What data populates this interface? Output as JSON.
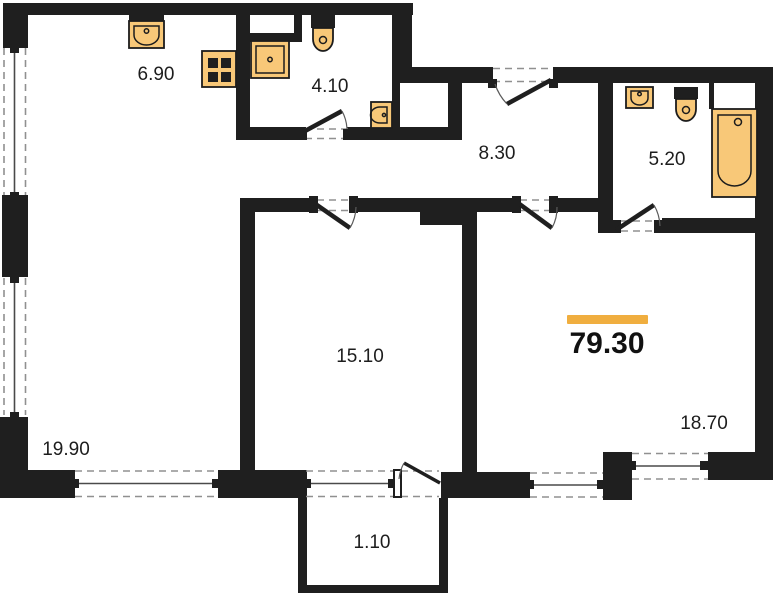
{
  "floorplan": {
    "type": "apartment-floor-plan",
    "total_area": "79.30",
    "rooms": [
      {
        "name": "kitchen-area",
        "area": "6.90",
        "fixtures": [
          "kitchen-sink",
          "stove"
        ]
      },
      {
        "name": "bathroom-small",
        "area": "4.10",
        "fixtures": [
          "washing-machine",
          "toilet",
          "hand-sink"
        ]
      },
      {
        "name": "hallway",
        "area": "8.30",
        "fixtures": []
      },
      {
        "name": "bathroom-large",
        "area": "5.20",
        "fixtures": [
          "sink",
          "toilet",
          "bathtub"
        ]
      },
      {
        "name": "bedroom",
        "area": "15.10",
        "fixtures": []
      },
      {
        "name": "living-room",
        "area": "18.70",
        "fixtures": []
      },
      {
        "name": "living-kitchen-area",
        "area": "19.90",
        "fixtures": []
      },
      {
        "name": "balcony",
        "area": "1.10",
        "fixtures": []
      }
    ],
    "colors": {
      "wall": "#1f1f1f",
      "fixture_fill": "#F8C878",
      "fixture_stroke": "#1c1c1c",
      "accent_bar": "#F0AE3F",
      "window_dash": "#909090",
      "background": "#FFFFFF",
      "label_text": "#1d1d1d"
    }
  }
}
